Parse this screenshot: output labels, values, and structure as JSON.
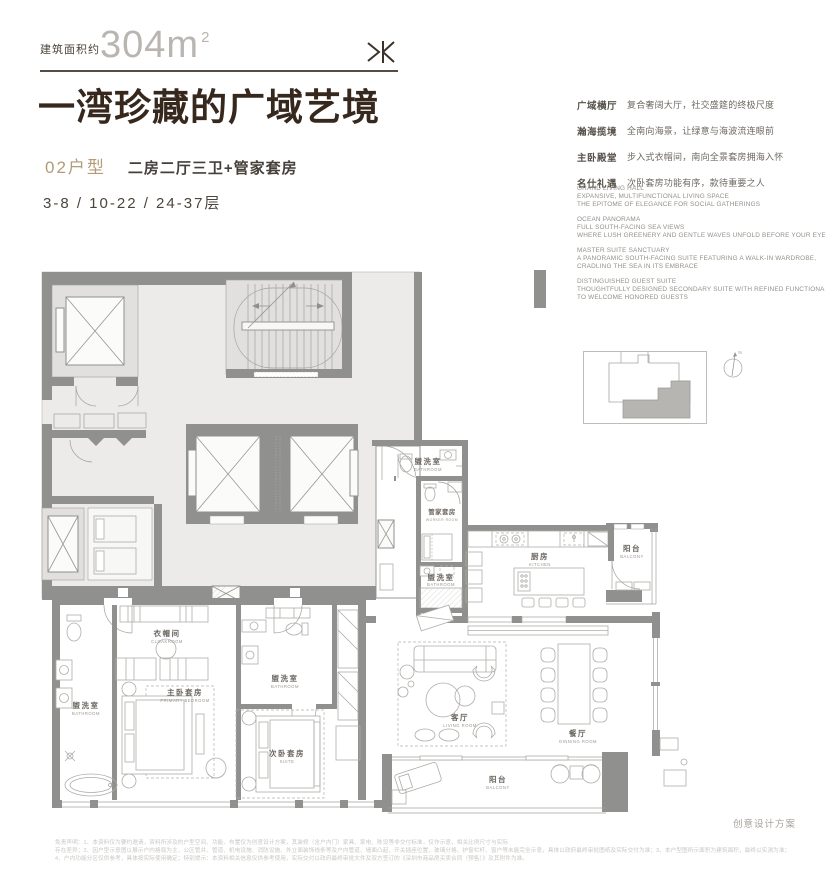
{
  "header": {
    "area_prefix": "建筑面积约",
    "area_number": "304m",
    "area_sup": "2",
    "title": "一湾珍藏的广域艺境",
    "unit_code": "02户型",
    "unit_desc": "二房二厅三卫+管家套房",
    "floors": "3-8 / 10-22 / 24-37层"
  },
  "features": [
    {
      "label": "广域横厅",
      "desc": "复合奢阔大厅，社交盛筵的终极尺度"
    },
    {
      "label": "瀚海揽境",
      "desc": "全南向海景，让绿意与海波流连眼前"
    },
    {
      "label": "主卧殿堂",
      "desc": "步入式衣帽间，南向全景套房拥海入怀"
    },
    {
      "label": "名仕礼遇",
      "desc": "次卧套房功能有序，款待重要之人"
    }
  ],
  "features_en": [
    {
      "lines": [
        "GRAND LIVING HALL",
        "EXPANSIVE, MULTIFUNCTIONAL LIVING SPACE",
        "THE EPITOME OF ELEGANCE FOR SOCIAL GATHERINGS"
      ]
    },
    {
      "lines": [
        "OCEAN PANORAMA",
        "FULL SOUTH-FACING SEA VIEWS",
        "WHERE LUSH GREENERY AND GENTLE WAVES UNFOLD BEFORE YOUR EYES"
      ]
    },
    {
      "lines": [
        "MASTER SUITE SANCTUARY",
        "A PANORAMIC SOUTH-FACING SUITE FEATURING A WALK-IN WARDROBE,",
        "CRADLING THE SEA IN ITS EMBRACE"
      ]
    },
    {
      "lines": [
        "DISTINGUISHED GUEST SUITE",
        "THOUGHTFULLY DESIGNED SECONDARY SUITE WITH REFINED FUNCTIONALITY",
        "TO WELCOME HONORED GUESTS"
      ]
    }
  ],
  "keyplan": {
    "north_label": "N"
  },
  "plan": {
    "rooms": [
      {
        "cn": "盥洗室",
        "en": "BATHROOM"
      },
      {
        "cn": "管家套房",
        "en": "WORKER ROOM"
      },
      {
        "cn": "盥洗室",
        "en": "BATHROOM"
      },
      {
        "cn": "厨房",
        "en": "KITCHEN"
      },
      {
        "cn": "阳台",
        "en": "BALCONY"
      },
      {
        "cn": "客厅",
        "en": "LIVING ROOM"
      },
      {
        "cn": "餐厅",
        "en": "DINNING ROOM"
      },
      {
        "cn": "阳台",
        "en": "BALCONY"
      },
      {
        "cn": "衣帽间",
        "en": "CLOAKROOM"
      },
      {
        "cn": "主卧套房",
        "en": "PRIMARY BEDROOM"
      },
      {
        "cn": "盥洗室",
        "en": "BATHROOM"
      },
      {
        "cn": "盥洗室",
        "en": "BATHROOM"
      },
      {
        "cn": "次卧套房",
        "en": "SUITE"
      }
    ]
  },
  "footer": {
    "scheme_note": "创意设计方案",
    "disclaimer": [
      "免责声明：1、本资料仅为要约邀请，资料所涉及的户型空间、功能、布置仅为创意设计方案，其装修（含户内门）家具、家电、陈设等非交付标准，仅作示意，相关比例尺寸与实际",
      "存在差异；2、因户型示意图以展示户内格局为主，公区管井、管道、机电设施、消防设施、外立面装饰线条等及户内管道、墙面凸起、开关插座位置、玻璃分格、护窗栏杆、窗户等未能完全示意，具体以政府最终审批图纸及实际交付为准；3、本户型图所示面积为建筑面积，最终以实测为准；",
      "4、户内功能分区仅供参考，具体按实际使用确定；特别提示：本资料相关信息仅供参考使用，实际交付以政府最终审批文件及双方签订的《深圳市商品房买卖合同（预售）》及其附件为准。"
    ]
  }
}
